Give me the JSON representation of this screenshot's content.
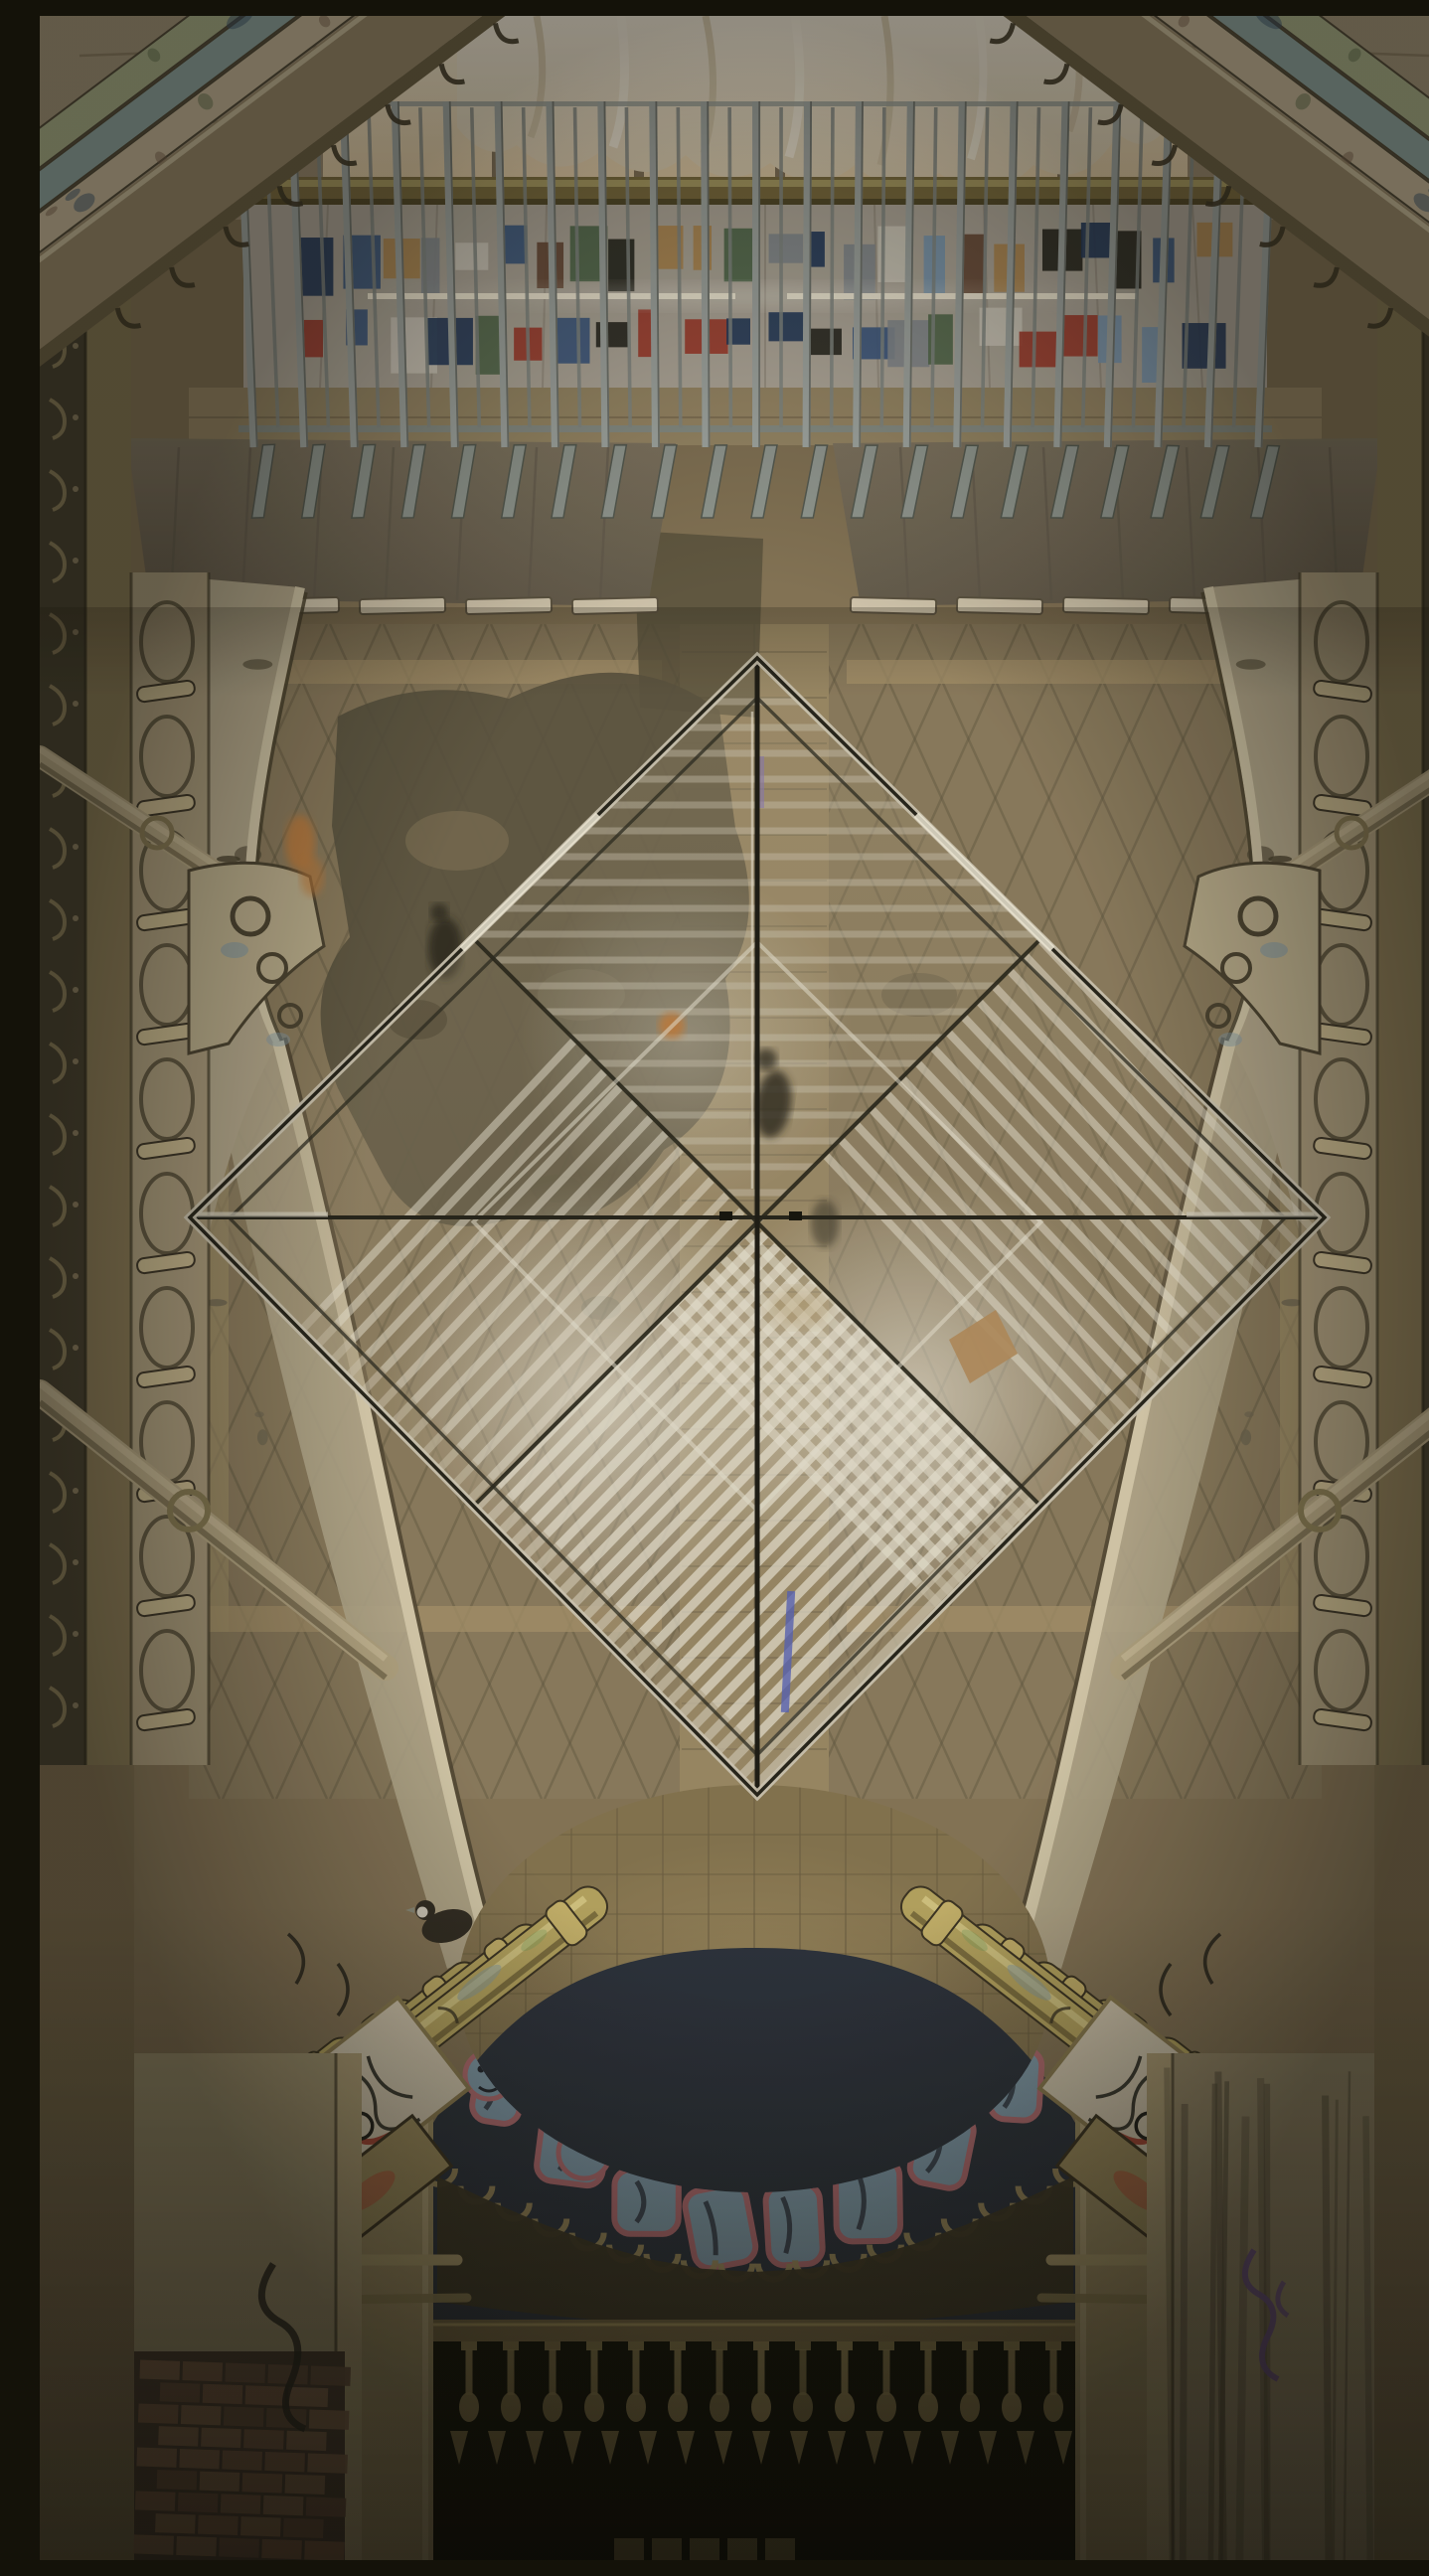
{
  "scene": {
    "description": "Low-angle photograph looking up through an abandoned ornate atrium: a glass pyramid skylight seen corner-on as a large diamond, peeling tiled walls, graffiti-covered column capitals, a poster-covered wall behind a metal railing at top, and a dark doorway with an upside-down balustrade at the bottom.",
    "lighting": "warm indoor artificial light, sepia tones",
    "symmetry": "near mirror symmetry about vertical axis"
  },
  "palette": {
    "wall": "#857457",
    "wall_dark": "#6c5f47",
    "center_strip": "#998764",
    "tile_line": "#5f5540",
    "tile_border": "#a5926b",
    "plaster_patch": "#57503c",
    "concrete": "#b6aea1",
    "poster_colors": [
      "#d9d3c6",
      "#3c5a86",
      "#7d9cba",
      "#a63a2c",
      "#27261f",
      "#6b4a37",
      "#b98d54",
      "#536b4e",
      "#8a8f96",
      "#233a5e"
    ],
    "fluorescent": "#fff6e0",
    "gold_pipe": "#7d6d3f",
    "railing_bar": "#a6aca9",
    "railing_bar_dark": "#5d605a",
    "railing_foot": "#949b95",
    "canopy": "#7c715f",
    "ledge_cap": "#d9cdb5",
    "curtain": "#f0e3cb",
    "skylight_glow": "#f6ead4",
    "mullion": "#6a5b46",
    "spandrel": "#b3a78c",
    "molding_light": "#d4c8aa",
    "molding_dark": "#483f2d",
    "niche": "#a99a7c",
    "niche_line": "#453e2c",
    "rung": "#c6b68e",
    "pipe": "#b1a281",
    "pipe_shadow": "#6a5e45",
    "column_yellow": "#b5a35f",
    "column_highlight": "#ded08e",
    "column_shadow": "#6a5c34",
    "column_line": "#3a3222",
    "graffiti_blue": "#7e98a8",
    "graffiti_pink": "#b06a70",
    "graffiti_navy": "#2b313c",
    "graffiti_white": "#c8c2b2",
    "graffiti_red": "#a23a2a",
    "scallop": "#9c8a5c",
    "grime": "#3b3526",
    "rail": "#6f6140",
    "baluster": "#8a7a4e",
    "void": "#0b0c07",
    "jamb": "#9a8a62",
    "brick": "#7a5a46",
    "brick_dark": "#684e3e",
    "brick_light": "#82624c",
    "mortar": "#463a2e",
    "purple_tag": "#6b4f8a",
    "lit_strip": "#6a5f3a",
    "bird": "#2f2921",
    "bird_face": "#cfc8bb",
    "person_dark": "#2a251c",
    "person_orange": "#c07a3a",
    "glass_frame": "#24221a",
    "glass_trim": "#d3ccba",
    "slat": "#e9e3d3",
    "slat_dim": "#cfc8b6",
    "glow": "#fdf9ee",
    "parcel": "#b08a5a",
    "blue_item": "#5660b5",
    "edge_strip": "#433d2d",
    "hook": "#8f7f5c",
    "stone_edge": "#857653",
    "cornice": "#9a8a6c",
    "stone_blocks": "#a3937a",
    "paint_green": "#a8b08a",
    "paint_teal": "#8fa7a3",
    "paint_cream": "#c9b99c",
    "streak": "#4f4736",
    "pilaster_left": "#9f9270",
    "pilaster_right": "#95886a"
  },
  "counts": {
    "railing_bars": 21,
    "railing_inner_bars": 20,
    "posters_row1": 24,
    "posters_row2": 22,
    "fluorescent_tubes": 2,
    "canopy_caps": 5,
    "edge_hooks": 24,
    "niche_motifs": 10,
    "cornice_brackets": 8,
    "lattice_spacing": 54,
    "graffiti_letters": 8,
    "scallops": 18,
    "balusters": 15,
    "dart_finials": 17,
    "brick_rows": 9,
    "brick_cols": 5,
    "streaks": 12,
    "speckles": 16
  },
  "people": {
    "figures_on_floor": 2,
    "figures_through_glass": 2,
    "bird_on_capital": 1
  }
}
